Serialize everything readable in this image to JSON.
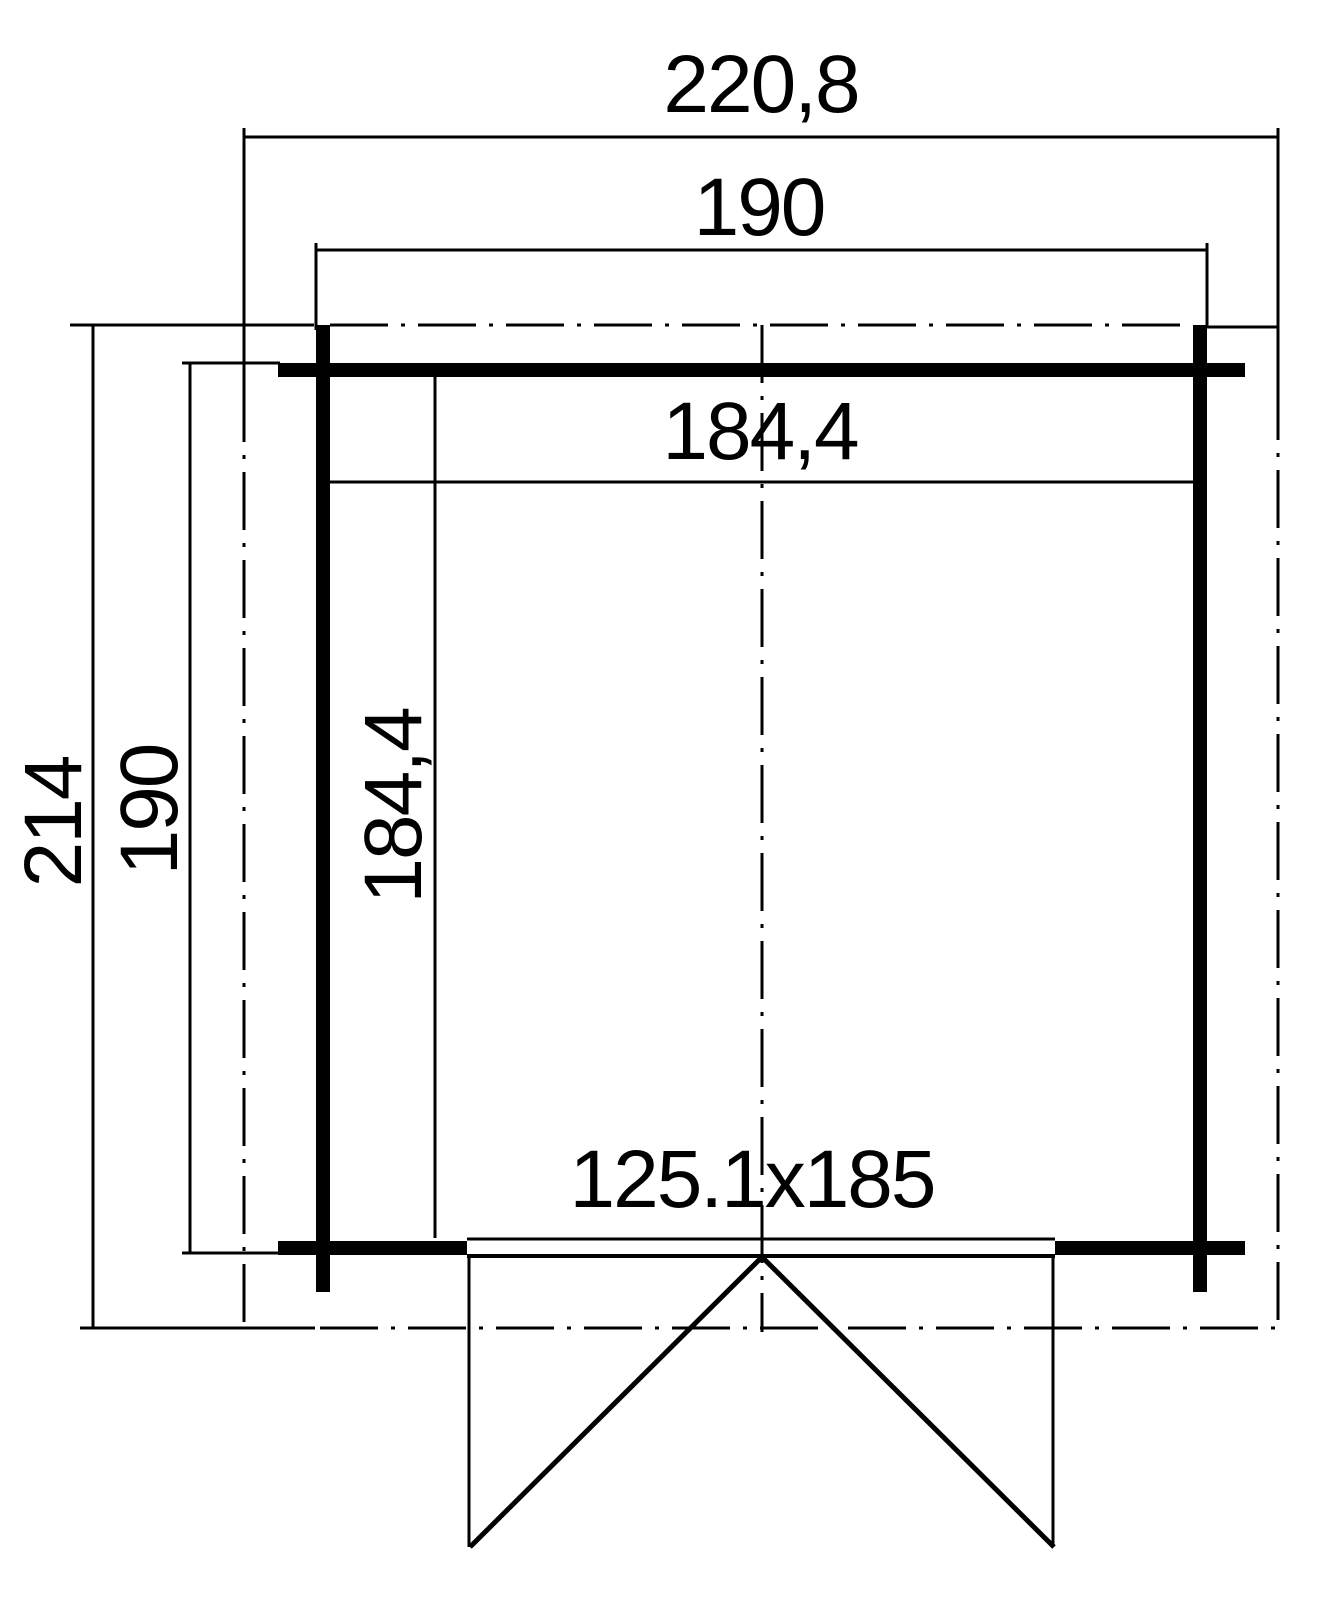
{
  "drawing": {
    "background": "#ffffff",
    "line_color": "#000000",
    "dimensions": {
      "overall_width": "220,8",
      "outer_width": "190",
      "inner_width": "184,4",
      "overall_depth": "214",
      "outer_depth": "190",
      "inner_depth": "184,4",
      "door_size": "125.1x185"
    }
  }
}
